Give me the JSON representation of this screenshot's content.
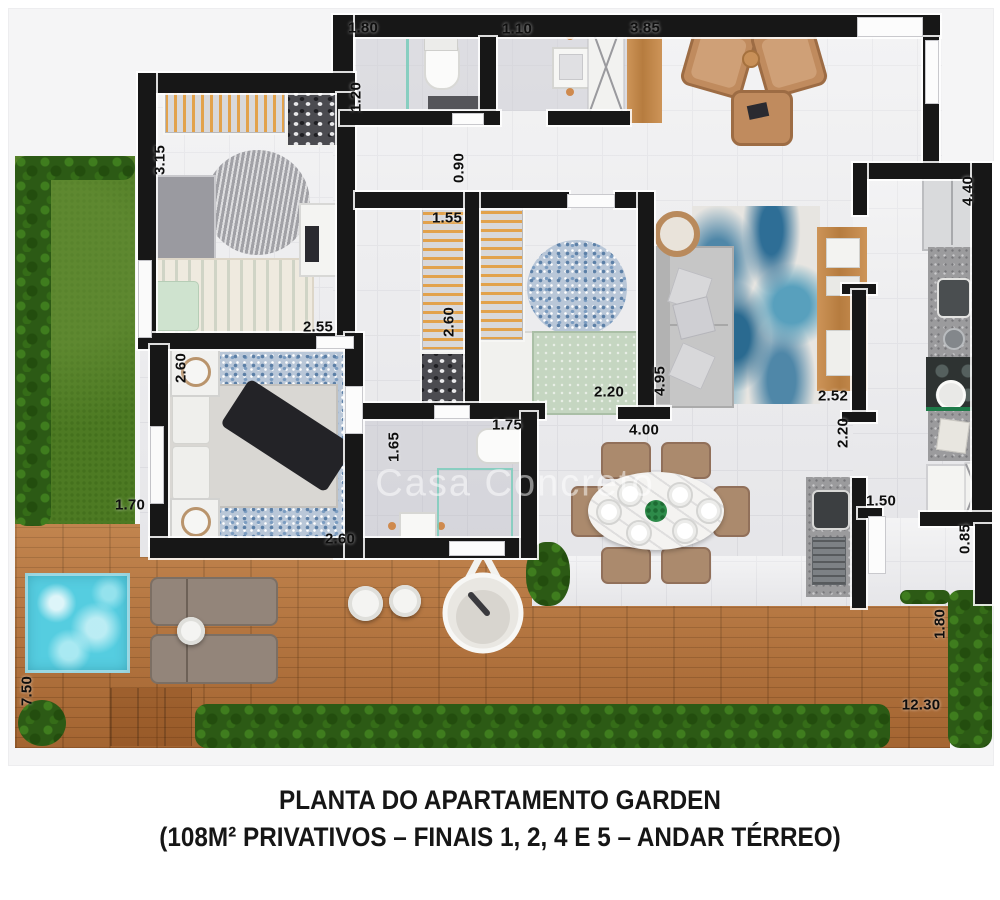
{
  "title": {
    "line1": "PLANTA DO APARTAMENTO GARDEN",
    "line2": "(108M² PRIVATIVOS – FINAIS 1, 2, 4 E 5 – ANDAR TÉRREO)"
  },
  "watermark": "Casa Concreto",
  "colors": {
    "wall": "#171717",
    "floor_tile": "#eaeaec",
    "deck_wood": "#b4713a",
    "grass": "#4d7a23",
    "hedge": "#2c5a15",
    "pool": "#55cde0",
    "furniture_wood": "#c89058",
    "rug_blue": "#6f93b8",
    "label_color": "#0e0e0e"
  },
  "dimensions": [
    {
      "label": "1.80",
      "x": 363,
      "y": 28,
      "rot": 0
    },
    {
      "label": "1.20",
      "x": 356,
      "y": 97,
      "rot": -90
    },
    {
      "label": "1.10",
      "x": 517,
      "y": 29,
      "rot": 0
    },
    {
      "label": "3.85",
      "x": 645,
      "y": 28,
      "rot": 0
    },
    {
      "label": "0.90",
      "x": 459,
      "y": 168,
      "rot": -90
    },
    {
      "label": "3.15",
      "x": 160,
      "y": 160,
      "rot": -90
    },
    {
      "label": "2.55",
      "x": 318,
      "y": 327,
      "rot": 0
    },
    {
      "label": "1.55",
      "x": 447,
      "y": 218,
      "rot": 0
    },
    {
      "label": "2.60",
      "x": 449,
      "y": 322,
      "rot": -90
    },
    {
      "label": "2.60",
      "x": 181,
      "y": 368,
      "rot": -90
    },
    {
      "label": "2.60",
      "x": 340,
      "y": 539,
      "rot": 0
    },
    {
      "label": "2.20",
      "x": 609,
      "y": 392,
      "rot": 0
    },
    {
      "label": "1.65",
      "x": 394,
      "y": 447,
      "rot": -90
    },
    {
      "label": "1.75",
      "x": 507,
      "y": 425,
      "rot": 0
    },
    {
      "label": "4.95",
      "x": 660,
      "y": 381,
      "rot": -90
    },
    {
      "label": "4.00",
      "x": 644,
      "y": 430,
      "rot": 0
    },
    {
      "label": "2.52",
      "x": 833,
      "y": 396,
      "rot": 0
    },
    {
      "label": "2.20",
      "x": 843,
      "y": 433,
      "rot": -90
    },
    {
      "label": "4.40",
      "x": 968,
      "y": 191,
      "rot": -90
    },
    {
      "label": "1.50",
      "x": 881,
      "y": 501,
      "rot": 0
    },
    {
      "label": "0.85",
      "x": 965,
      "y": 539,
      "rot": -90
    },
    {
      "label": "1.70",
      "x": 130,
      "y": 505,
      "rot": 0
    },
    {
      "label": "7.50",
      "x": 27,
      "y": 691,
      "rot": -90
    },
    {
      "label": "1.80",
      "x": 940,
      "y": 624,
      "rot": -90
    },
    {
      "label": "12.30",
      "x": 921,
      "y": 705,
      "rot": 0
    }
  ]
}
